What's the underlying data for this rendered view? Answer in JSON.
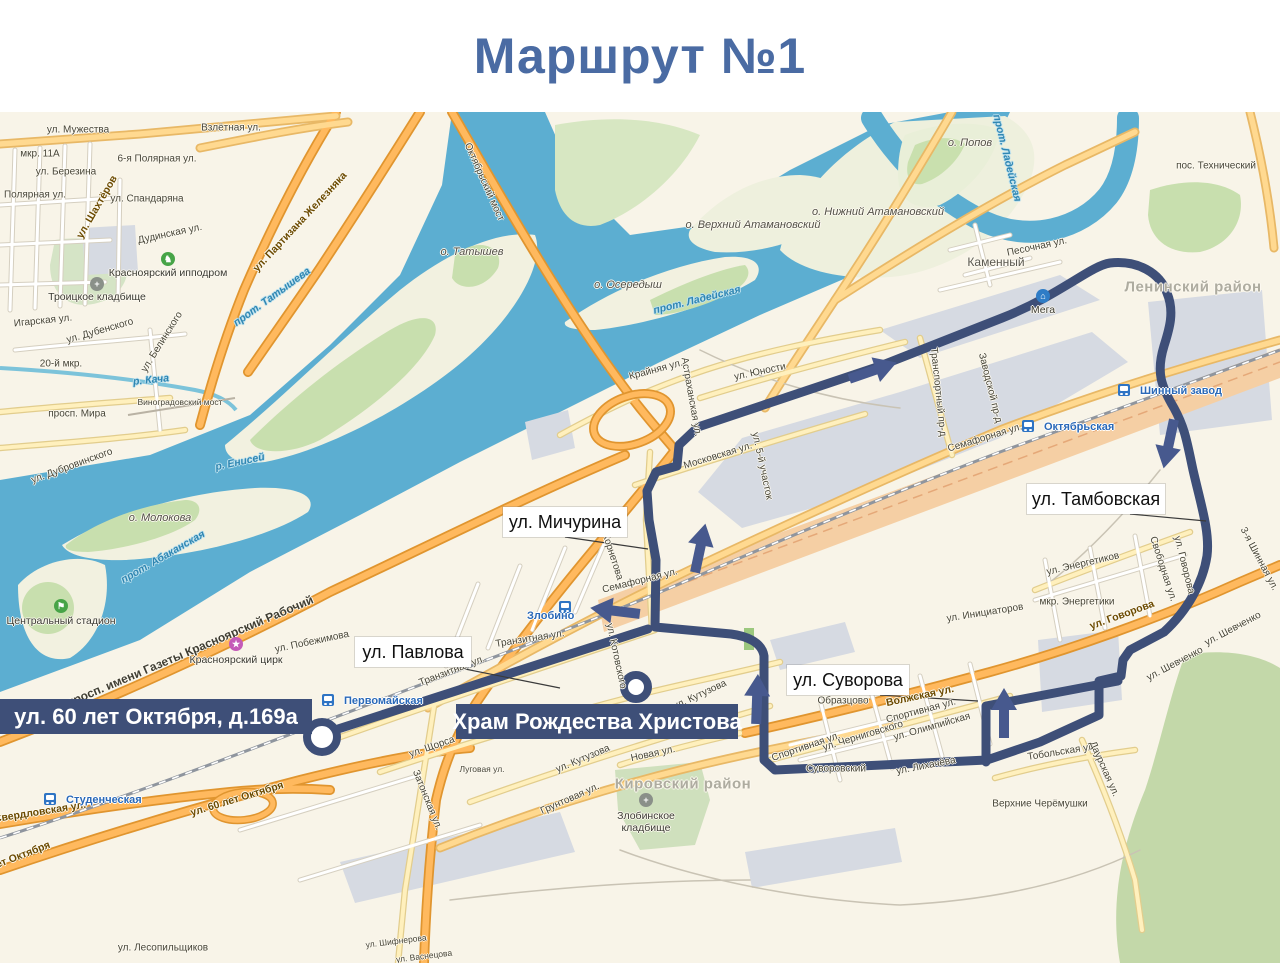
{
  "title": "Маршрут №1",
  "colors": {
    "title": "#4a6ba3",
    "route": "#3e4f78",
    "arrow": "#47598e",
    "water": "#5caed1",
    "land": "#f8f4e8"
  },
  "route": {
    "width": 9,
    "paths": [
      {
        "name": "route-loop",
        "d": "M698,427 L880,366 L1002,318 C1060,295 1090,266 1110,263 C1138,260 1160,273 1167,293 C1175,312 1169,330 1164,346 C1156,372 1161,386 1174,408 C1185,428 1187,442 1193,470 C1201,505 1210,532 1207,556 C1203,582 1188,610 1164,632 L1130,650 L1123,660 L1121,676 L1099,681 L1099,715 L1040,742 L987,760 L775,770 L764,760 L764,656 C762,642 746,636 731,634 L655,627 L656,560 L649,520 L647,491 L656,472 L677,466 L679,445 Z"
      },
      {
        "name": "route-tail",
        "d": "M648,629 L338,729"
      },
      {
        "name": "route-connector",
        "d": "M986,762 L986,706 L1118,681"
      }
    ],
    "stops": [
      {
        "name": "terminal-stop",
        "x": 322,
        "y": 737,
        "r": 15
      },
      {
        "name": "church-stop",
        "x": 636,
        "y": 687,
        "r": 12
      }
    ],
    "arrows": [
      {
        "x": 872,
        "y": 371,
        "a": -19
      },
      {
        "x": 1169,
        "y": 443,
        "a": 102
      },
      {
        "x": 1004,
        "y": 714,
        "a": -90
      },
      {
        "x": 757,
        "y": 700,
        "a": -88
      },
      {
        "x": 700,
        "y": 549,
        "a": -78
      },
      {
        "x": 616,
        "y": 611,
        "a": 187
      }
    ]
  },
  "map": {
    "banners": [
      {
        "text": "ул. 60 лет Октября, д.169а",
        "x": 0,
        "y": 699,
        "w": 312,
        "h": 35
      },
      {
        "text": "Храм Рождества Христова",
        "x": 456,
        "y": 704,
        "w": 282,
        "h": 35
      }
    ],
    "callouts": [
      {
        "text": "ул. Мичурина",
        "x": 503,
        "y": 507,
        "w": 124,
        "h": 30,
        "line": [
          565,
          537,
          648,
          549
        ]
      },
      {
        "text": "ул. Павлова",
        "x": 355,
        "y": 637,
        "w": 116,
        "h": 30,
        "line": [
          455,
          667,
          560,
          688
        ]
      },
      {
        "text": "ул. Тамбовская",
        "x": 1027,
        "y": 484,
        "w": 138,
        "h": 30,
        "line": [
          1130,
          514,
          1206,
          521
        ]
      },
      {
        "text": "ул. Суворова",
        "x": 787,
        "y": 665,
        "w": 122,
        "h": 30,
        "line": [
          880,
          695,
          978,
          701
        ]
      }
    ],
    "stations": [
      {
        "name": "Студенческая",
        "ix": 50,
        "iy": 799,
        "tx": 66,
        "ty": 800
      },
      {
        "name": "Первомайская",
        "ix": 328,
        "iy": 700,
        "tx": 344,
        "ty": 701
      },
      {
        "name": "Злобино",
        "ix": 565,
        "iy": 607,
        "tx": 527,
        "ty": 616
      },
      {
        "name": "Октябрьская",
        "ix": 1028,
        "iy": 426,
        "tx": 1044,
        "ty": 427
      },
      {
        "name": "Шинный завод",
        "ix": 1124,
        "iy": 390,
        "tx": 1140,
        "ty": 391
      }
    ],
    "pois": [
      {
        "name": "Мега",
        "x": 1043,
        "y": 296,
        "ty": 310,
        "color": "#2f7cc6",
        "g": "⌂"
      },
      {
        "name": "Красноярский ипподром",
        "x": 168,
        "y": 259,
        "ty": 273,
        "color": "#47a447",
        "g": "♞"
      },
      {
        "name": "Центральный стадион",
        "x": 61,
        "y": 606,
        "ty": 621,
        "color": "#47a447",
        "g": "⚑"
      },
      {
        "name": "Красноярский цирк",
        "x": 236,
        "y": 644,
        "ty": 660,
        "color": "#c45ab8",
        "g": "★"
      },
      {
        "name": "Троицкое кладбище",
        "x": 97,
        "y": 284,
        "ty": 297,
        "color": "#8a9089",
        "g": "+"
      },
      {
        "name": "Злобинское\nкладбище",
        "x": 646,
        "y": 800,
        "ty": 822,
        "color": "#8a9089",
        "g": "+"
      }
    ],
    "districts": [
      {
        "text": "Ленинский район",
        "x": 1193,
        "y": 287
      },
      {
        "text": "Кировский район",
        "x": 683,
        "y": 784
      }
    ],
    "water_labels": [
      [
        "р. Енисей",
        240,
        462,
        -12
      ],
      [
        "прот. Татышева",
        272,
        297,
        -36
      ],
      [
        "прот. Абаканская",
        163,
        557,
        -30
      ],
      [
        "р. Кача",
        151,
        380,
        -6
      ],
      [
        "прот. Ладейская",
        1007,
        158,
        76
      ],
      [
        "прот. Ладейская",
        697,
        300,
        -14
      ]
    ],
    "island_labels": [
      [
        "о. Татышев",
        472,
        252,
        0
      ],
      [
        "о. Молокова",
        160,
        518,
        0
      ],
      [
        "о. Осередыш",
        628,
        285,
        0
      ],
      [
        "о. Попов",
        970,
        143,
        0
      ],
      [
        "о. Нижний Атамановский",
        878,
        212,
        0
      ],
      [
        "о. Верхний Атамановский",
        753,
        225,
        0
      ]
    ],
    "streets": [
      [
        "ул. Мужества",
        78,
        130,
        0
      ],
      [
        "Взлётная ул.",
        231,
        128,
        0
      ],
      [
        "мкр. 11А",
        40,
        154,
        0
      ],
      [
        "6-я Полярная ул.",
        157,
        159,
        0
      ],
      [
        "ул. Березина",
        66,
        172,
        0
      ],
      [
        "Полярная ул.",
        35,
        195,
        0
      ],
      [
        "ул. Спандаряна",
        147,
        199,
        0
      ],
      [
        "ул. Шахтёров",
        97,
        207,
        -60,
        "or"
      ],
      [
        "ул. Партизана Железняка",
        300,
        222,
        -47,
        "or"
      ],
      [
        "Дудинская ул.",
        170,
        234,
        -12
      ],
      [
        "Игарская ул.",
        43,
        321,
        -6
      ],
      [
        "ул. Дубенского",
        100,
        331,
        -16
      ],
      [
        "ул. Белинского",
        162,
        342,
        -58
      ],
      [
        "20-й мкр.",
        61,
        364,
        0
      ],
      [
        "просп. Мира",
        77,
        414,
        0
      ],
      [
        "Виноградовский мост",
        180,
        402,
        0,
        "sm"
      ],
      [
        "ул. Дубровинского",
        72,
        466,
        -20
      ],
      [
        "Октябрьский мост",
        484,
        182,
        66
      ],
      [
        "пос. Технический",
        1216,
        166,
        0
      ],
      [
        "Каменный",
        996,
        262,
        0,
        "md"
      ],
      [
        "Песочная ул.",
        1037,
        247,
        -12
      ],
      [
        "Крайняя ул.",
        656,
        370,
        -15
      ],
      [
        "ул. Юности",
        760,
        372,
        -12
      ],
      [
        "Астраханская ул.",
        691,
        397,
        80
      ],
      [
        "Московская ул.",
        718,
        456,
        -17
      ],
      [
        "ул. 5-й участок",
        762,
        466,
        78
      ],
      [
        "Транспортный пр-д",
        938,
        392,
        84
      ],
      [
        "Заводской пр-д",
        990,
        388,
        76
      ],
      [
        "Семафорная ул.",
        985,
        438,
        -17
      ],
      [
        "Семафорная ул.",
        640,
        581,
        -14
      ],
      [
        "ул. Корнетова",
        610,
        549,
        72
      ],
      [
        "мкр. Энергетики",
        1077,
        602,
        0
      ],
      [
        "ул. Энергетиков",
        1083,
        564,
        -13
      ],
      [
        "ул. Инициаторов",
        985,
        613,
        -9
      ],
      [
        "ул. Говорова",
        1122,
        615,
        -20,
        "or"
      ],
      [
        "ул. Говорова",
        1184,
        565,
        76
      ],
      [
        "Свободная ул.",
        1163,
        569,
        72
      ],
      [
        "ул. Шевченко",
        1233,
        629,
        -28
      ],
      [
        "ул. Шевченко",
        1175,
        664,
        -28
      ],
      [
        "3-я Шинная ул.",
        1259,
        559,
        62
      ],
      [
        "Тобольская ул.",
        1062,
        752,
        -9
      ],
      [
        "Даурская ул.",
        1104,
        769,
        66
      ],
      [
        "Волжская ул.",
        920,
        696,
        -12,
        "or"
      ],
      [
        "Образцово",
        843,
        701,
        0
      ],
      [
        "Спортивная ул.",
        921,
        711,
        -15
      ],
      [
        "Спортивная ул.",
        806,
        747,
        -19
      ],
      [
        "ул. Черниговского",
        863,
        736,
        -17
      ],
      [
        "ул. Олимпийская",
        932,
        727,
        -16
      ],
      [
        "Суворовский",
        836,
        769,
        0
      ],
      [
        "ул. Лихачёва",
        926,
        766,
        -11
      ],
      [
        "ул. Котовского",
        616,
        656,
        78
      ],
      [
        "Транзитная ул.",
        530,
        639,
        -9
      ],
      [
        "Транзитная ул.",
        452,
        671,
        -21
      ],
      [
        "ул. Щорса",
        432,
        747,
        -19
      ],
      [
        "ул. Кутузова",
        583,
        759,
        -23
      ],
      [
        "ул. Кутузова",
        700,
        695,
        -25
      ],
      [
        "Луговая ул.",
        482,
        769,
        0,
        "sm"
      ],
      [
        "Затонская ул.",
        427,
        800,
        68
      ],
      [
        "Новая ул.",
        653,
        754,
        -12
      ],
      [
        "Грунтовая ул.",
        570,
        799,
        -24
      ],
      [
        "Верхние Черёмушки",
        1040,
        804,
        0
      ],
      [
        "ул. Лесопильщиков",
        163,
        948,
        0
      ],
      [
        "Свердловская ул.",
        40,
        812,
        -9,
        "or"
      ],
      [
        "ул. 60 лет Октября",
        237,
        799,
        -17,
        "or"
      ],
      [
        "лет Октября",
        20,
        856,
        -21,
        "or"
      ],
      [
        "просп. имени Газеты Красноярский Рабочий",
        190,
        651,
        -23,
        "lg"
      ],
      [
        "ул. Побежимова",
        312,
        642,
        -12
      ],
      [
        "ул. Шифнерова",
        396,
        941,
        -7,
        "sm"
      ],
      [
        "ул. Васнецова",
        424,
        956,
        -7,
        "sm"
      ]
    ]
  }
}
